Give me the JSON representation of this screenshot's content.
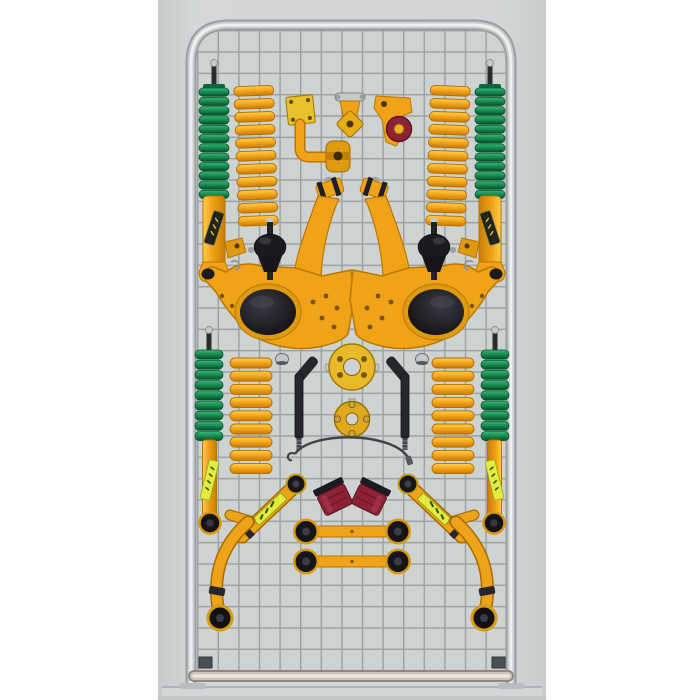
{
  "scene": {
    "page_background": "#ffffff",
    "photo_background": "#d3d5d6"
  },
  "palette": {
    "photo_bg": "#d3d5d6",
    "mesh_bg": "#ced2d0",
    "mesh_wire": "#9aa1a4",
    "frame_light": "#eef0f0",
    "frame_mid": "#c8cccd",
    "frame_dark": "#999ea1",
    "part_yellow": "#f0a319",
    "part_yellow_deep": "#e09a12",
    "part_outline": "#b97700",
    "boot_green": "#1d9155",
    "boot_green_dark": "#0a5530",
    "rubber_black": "#17171b",
    "bushing_red": "#8e2133",
    "sticker_yellow": "#e4ea3e",
    "sticker_text_green": "#274d12",
    "metal_silver": "#c7cacc",
    "base_warm": "#cfc3ba"
  },
  "stand": {
    "type": "wire-mesh-display-rack",
    "frame_color": "#c8cccd",
    "mesh_cell_px": 21
  },
  "kit": {
    "parts": [
      {
        "name": "front-strut-with-dust-boot",
        "count": 2,
        "colors": [
          "#1d9155",
          "#f0a319"
        ]
      },
      {
        "name": "front-coil-spring",
        "count": 2,
        "colors": [
          "#f0a319"
        ]
      },
      {
        "name": "steering-damper-bracket",
        "count": 1,
        "colors": [
          "#f0a319"
        ]
      },
      {
        "name": "spring-shackle",
        "count": 1,
        "colors": [
          "#f0a319",
          "#c7cacc"
        ]
      },
      {
        "name": "bushing-bracket",
        "count": 1,
        "colors": [
          "#f0a319",
          "#8e2133"
        ]
      },
      {
        "name": "lower-control-arm",
        "count": 2,
        "colors": [
          "#f0a319",
          "#17171b"
        ]
      },
      {
        "name": "flex-joint-bushing",
        "count": 2,
        "colors": [
          "#17171b"
        ]
      },
      {
        "name": "tie-rod-end",
        "count": 2,
        "colors": [
          "#17171b",
          "#c7cacc"
        ]
      },
      {
        "name": "coil-spacer-plate-large",
        "count": 1,
        "colors": [
          "#e8b929"
        ]
      },
      {
        "name": "coil-spacer-plate-small",
        "count": 1,
        "colors": [
          "#dfa81f"
        ]
      },
      {
        "name": "braided-brake-hose",
        "count": 1,
        "colors": [
          "#3e4145"
        ]
      },
      {
        "name": "rear-shock-absorber-with-boot",
        "count": 2,
        "colors": [
          "#1d9155",
          "#f0a319",
          "#e4ea3e"
        ]
      },
      {
        "name": "rear-coil-spring",
        "count": 2,
        "colors": [
          "#f0a319"
        ]
      },
      {
        "name": "labelled-link-arm",
        "count": 2,
        "colors": [
          "#f0a319",
          "#e4ea3e"
        ]
      },
      {
        "name": "curved-trailing-arm",
        "count": 2,
        "colors": [
          "#f0a319",
          "#17171b"
        ]
      },
      {
        "name": "panhard-link-bar",
        "count": 2,
        "colors": [
          "#f0a319",
          "#17171b"
        ]
      },
      {
        "name": "polyurethane-bump-stop",
        "count": 2,
        "colors": [
          "#8e2133"
        ]
      }
    ]
  }
}
